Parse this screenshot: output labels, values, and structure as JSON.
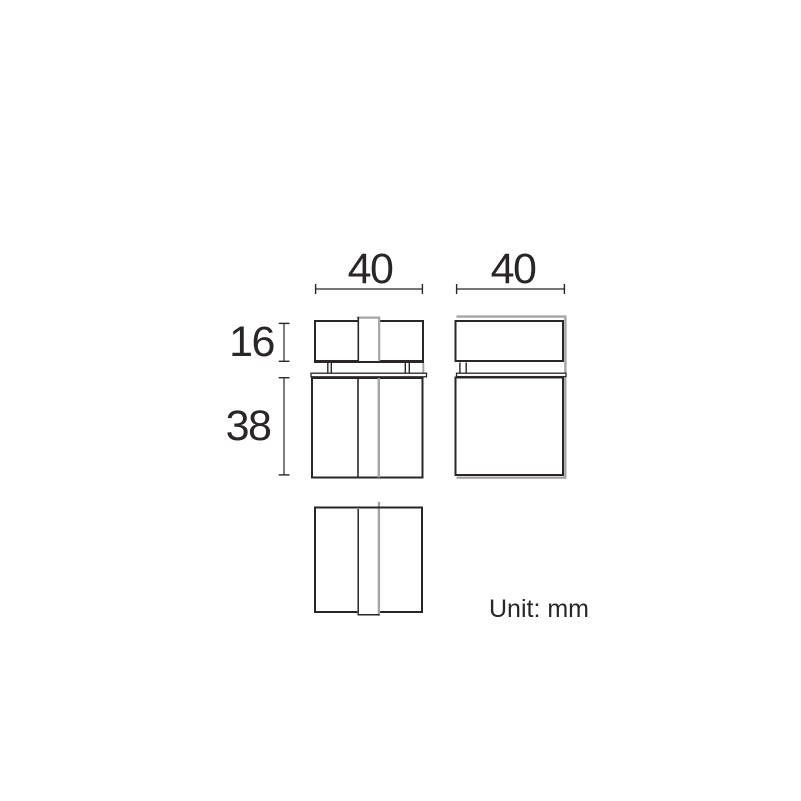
{
  "drawing": {
    "dimension_labels": {
      "front_width": "40",
      "side_depth": "40",
      "top_section_height": "16",
      "bottom_section_height": "38"
    },
    "unit_note": "Unit: mm",
    "colors": {
      "line_dark": "#2a2526",
      "line_gray": "#a7a4a5",
      "background": "#ffffff"
    }
  }
}
